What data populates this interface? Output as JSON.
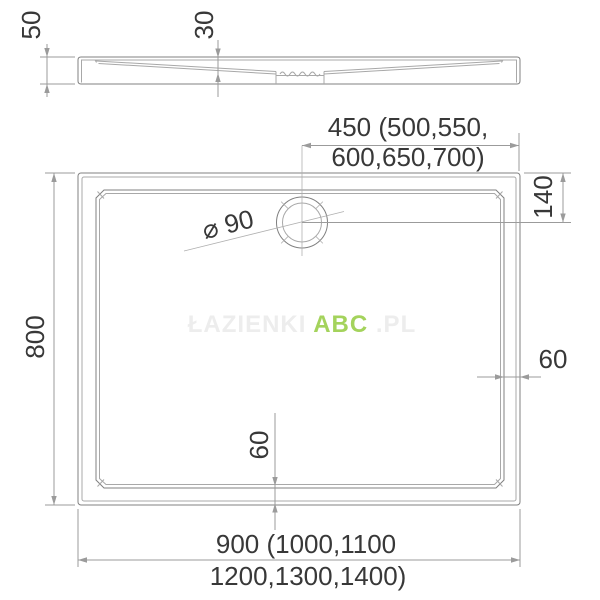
{
  "side_view": {
    "overall_height_label": "50",
    "basin_depth_label": "30"
  },
  "plan_view": {
    "drain_offset_x_line1": "450 (500,550,",
    "drain_offset_x_line2": "600,650,700)",
    "drain_offset_y_label": "140",
    "height_label": "800",
    "rim_width_right_label": "60",
    "rim_width_bottom_label": "60",
    "drain_diameter_label": "⌀ 90",
    "width_line1": "900 (1000,1100",
    "width_line2": "1200,1300,1400)"
  },
  "watermark": {
    "prefix": "ŁAZIENKI",
    "brand": "ABC",
    "suffix": ".PL",
    "brand_color": "#a4d35c",
    "faint_color": "#ededed"
  },
  "colors": {
    "outline": "#808080",
    "secondary_line": "#a8a8a8",
    "dimension_line": "#9b9b9b",
    "text": "#383838",
    "background": "#ffffff"
  }
}
